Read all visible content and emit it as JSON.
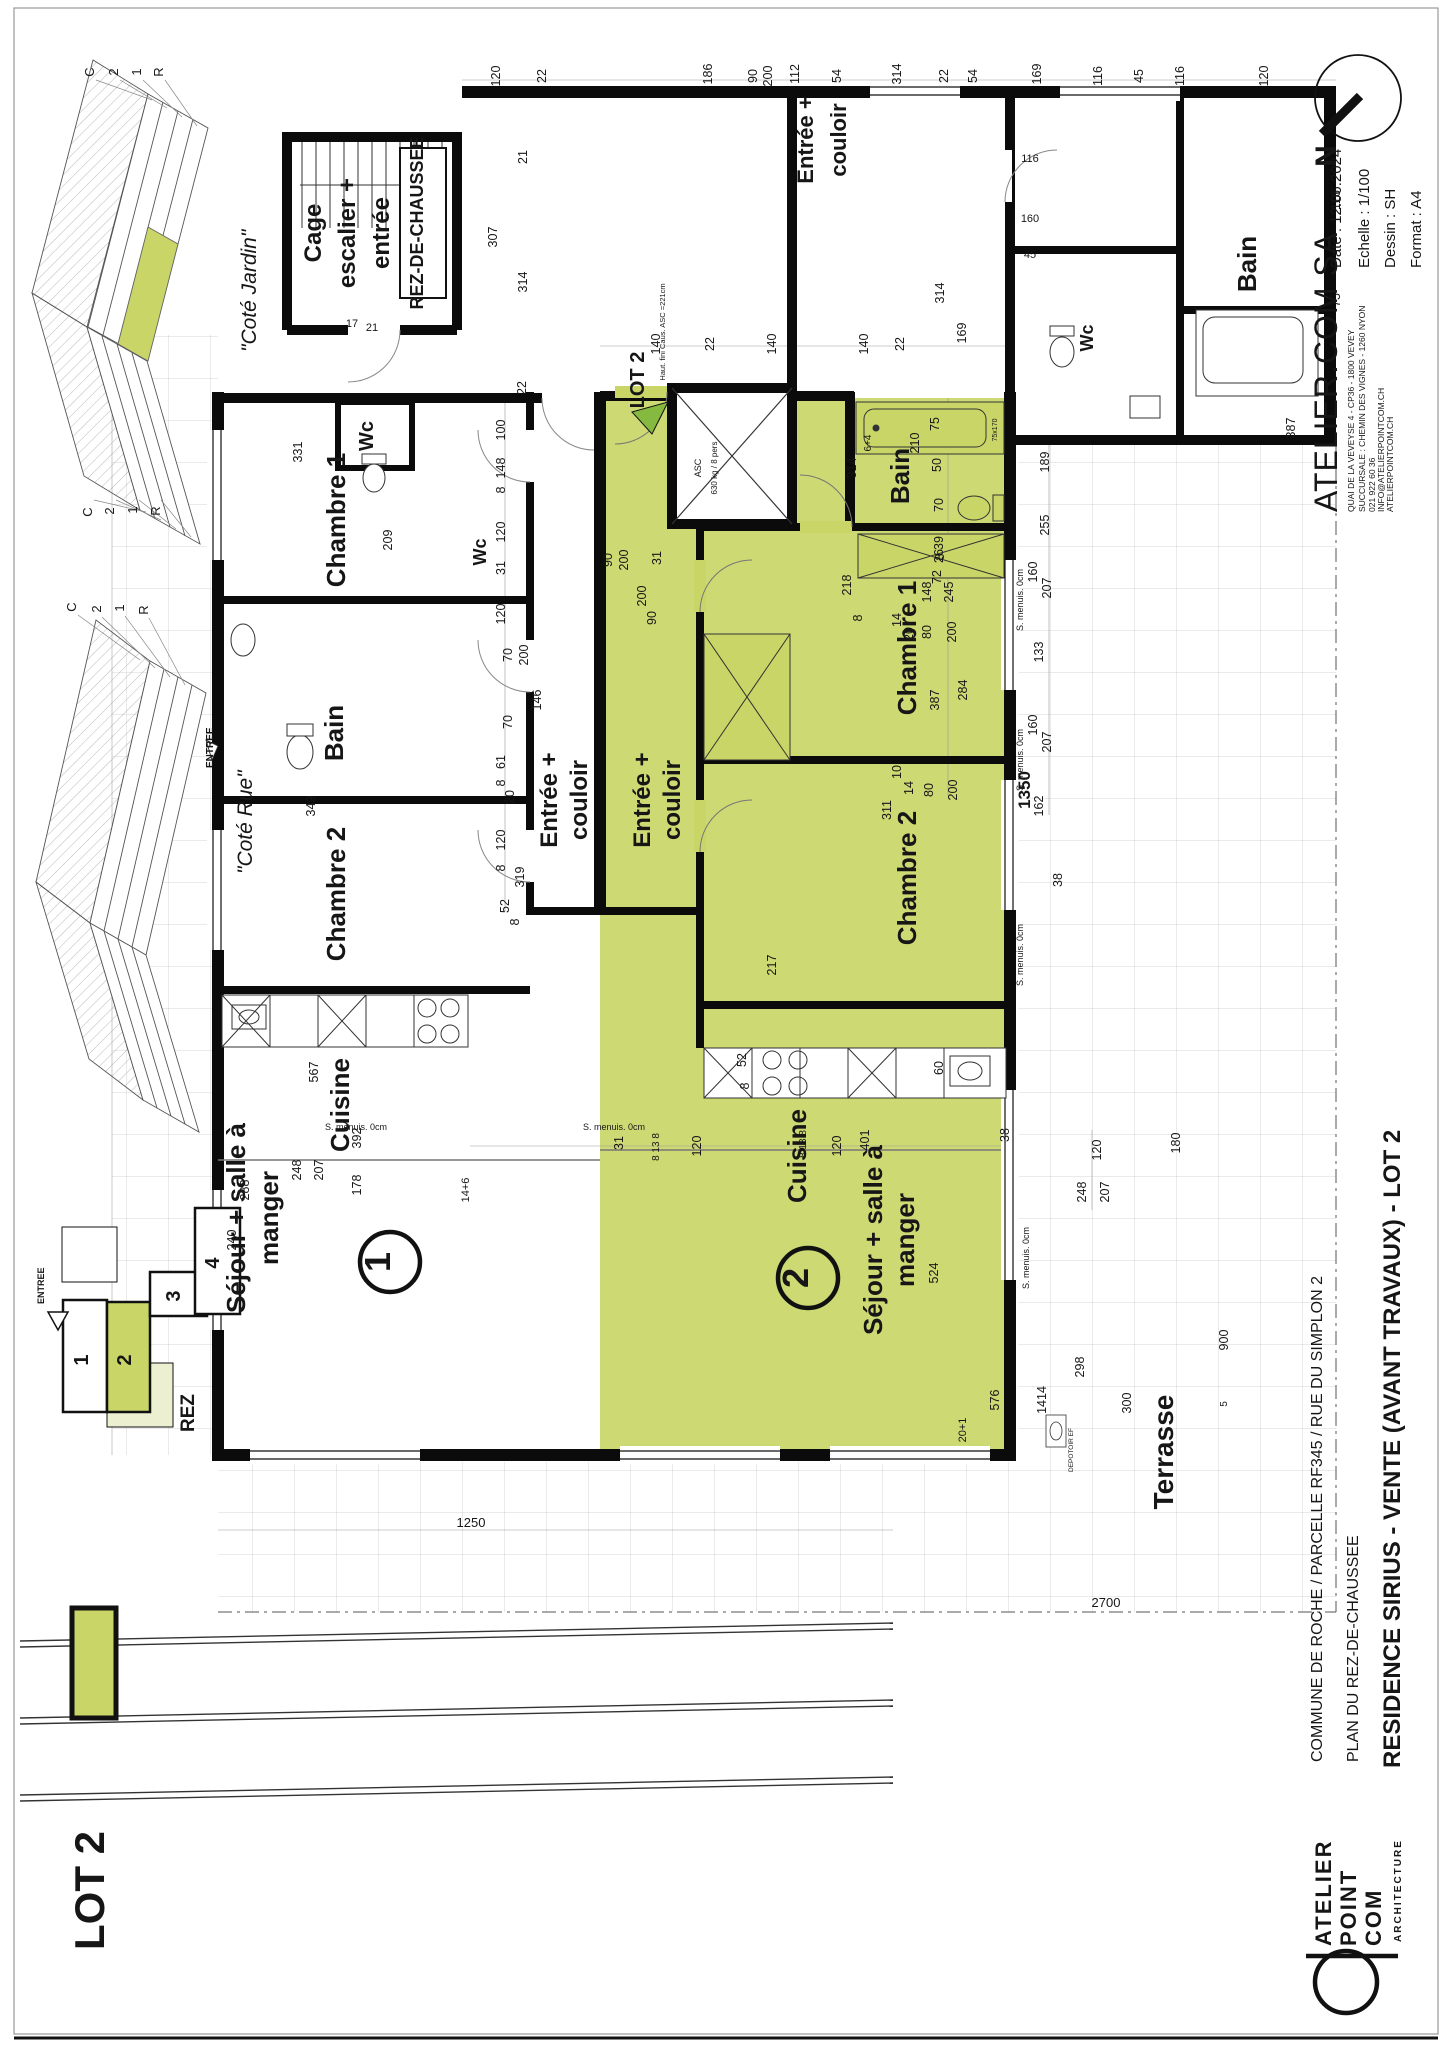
{
  "document": {
    "type": "architectural floor plan sheet",
    "sheet_format": "A4 landscape rotated 90deg CCW"
  },
  "colors": {
    "lot_green": "#c9d667",
    "terrace_light_green": "#edf0d0",
    "arrow_green": "#86b93f",
    "wall_black": "#0b0b0b",
    "grid_gray": "#c9c9c9"
  },
  "groups": {
    "title_block": [
      {
        "t": "Date : 12.06.2024",
        "x": 1341,
        "y": 268,
        "s": 15,
        "a": "start"
      },
      {
        "t": "Echelle : 1/100",
        "x": 1369,
        "y": 268,
        "s": 15,
        "a": "start"
      },
      {
        "t": "Dessin : SH",
        "x": 1395,
        "y": 268,
        "s": 15,
        "a": "start"
      },
      {
        "t": "Format : A4",
        "x": 1421,
        "y": 268,
        "s": 15,
        "a": "start"
      },
      {
        "t": "ATELIER.COM SA",
        "x": 1337,
        "y": 512,
        "s": 32,
        "a": "start",
        "ls": 1
      },
      {
        "t": "QUAI DE LA VEVEYSE 4 - CP36 - 1800 VEVEY",
        "x": 1354,
        "y": 512,
        "s": 8.5,
        "a": "start"
      },
      {
        "t": "SUCCURSALE : CHEMIN DES VIGNES - 1260 NYON",
        "x": 1365,
        "y": 512,
        "s": 8.5,
        "a": "start"
      },
      {
        "t": "021 922 60 36",
        "x": 1375,
        "y": 512,
        "s": 8.5,
        "a": "start"
      },
      {
        "t": "INFO@ATELIERPOINTCOM.CH",
        "x": 1384,
        "y": 512,
        "s": 8.5,
        "a": "start"
      },
      {
        "t": "ATELIERPOINTCOM.CH",
        "x": 1393,
        "y": 512,
        "s": 8.5,
        "a": "start"
      },
      {
        "t": "COMMUNE DE ROCHE / PARCELLE RF345 / RUE DU SIMPLON 2",
        "x": 1322,
        "y": 1762,
        "s": 16,
        "a": "start"
      },
      {
        "t": "PLAN DU REZ-DE-CHAUSSEE",
        "x": 1358,
        "y": 1762,
        "s": 16,
        "a": "start"
      },
      {
        "t": "RESIDENCE SIRIUS  -  VENTE (AVANT TRAVAUX)  -  LOT 2",
        "x": 1400,
        "y": 1768,
        "s": 24,
        "b": 1,
        "a": "start"
      },
      {
        "t": "N",
        "x": 1336,
        "y": 156,
        "s": 30,
        "b": 1
      }
    ],
    "logo": [
      {
        "t": "ATELIER",
        "x": 1331,
        "y": 1946,
        "s": 22,
        "b": 1,
        "a": "start",
        "ls": 2
      },
      {
        "t": "POINT",
        "x": 1356,
        "y": 1946,
        "s": 22,
        "b": 1,
        "a": "start",
        "ls": 2
      },
      {
        "t": "COM",
        "x": 1381,
        "y": 1946,
        "s": 22,
        "b": 1,
        "a": "start",
        "ls": 2
      },
      {
        "t": "ARCHITECTURE",
        "x": 1401,
        "y": 1942,
        "s": 10,
        "b": 1,
        "a": "start",
        "ls": 2
      }
    ],
    "legend": [
      {
        "t": "LOT 2",
        "x": 104,
        "y": 1950,
        "s": 42,
        "b": 1,
        "a": "start"
      }
    ],
    "keyplan": [
      {
        "t": "1",
        "x": 88,
        "y": 1360,
        "s": 20,
        "b": 1
      },
      {
        "t": "2",
        "x": 131,
        "y": 1360,
        "s": 20,
        "b": 1
      },
      {
        "t": "3",
        "x": 180,
        "y": 1296,
        "s": 20,
        "b": 1
      },
      {
        "t": "4",
        "x": 219,
        "y": 1263,
        "s": 20,
        "b": 1
      },
      {
        "t": "ENTREE",
        "x": 44,
        "y": 1304,
        "s": 9,
        "b": 1,
        "a": "start"
      },
      {
        "t": "REZ",
        "x": 194,
        "y": 1432,
        "s": 19,
        "b": 1,
        "a": "start"
      }
    ],
    "axo": [
      {
        "t": "\"Coté Jardin\"",
        "x": 256,
        "y": 352,
        "s": 21,
        "i": 1,
        "a": "start"
      },
      {
        "t": "\"Coté Rue\"",
        "x": 252,
        "y": 874,
        "s": 21,
        "i": 1,
        "a": "start"
      },
      {
        "t": "C",
        "x": 94,
        "y": 72,
        "s": 13
      },
      {
        "t": "2",
        "x": 118,
        "y": 72,
        "s": 13
      },
      {
        "t": "1",
        "x": 141,
        "y": 72,
        "s": 13
      },
      {
        "t": "R",
        "x": 163,
        "y": 72,
        "s": 13
      },
      {
        "t": "C",
        "x": 92,
        "y": 512,
        "s": 13
      },
      {
        "t": "2",
        "x": 114,
        "y": 511,
        "s": 13
      },
      {
        "t": "1",
        "x": 137,
        "y": 510,
        "s": 13
      },
      {
        "t": "R",
        "x": 160,
        "y": 511,
        "s": 13
      },
      {
        "t": "C",
        "x": 76,
        "y": 607,
        "s": 13
      },
      {
        "t": "2",
        "x": 101,
        "y": 609,
        "s": 13
      },
      {
        "t": "1",
        "x": 124,
        "y": 608,
        "s": 13
      },
      {
        "t": "R",
        "x": 148,
        "y": 610,
        "s": 13
      },
      {
        "t": "ENTREE",
        "x": 213,
        "y": 768,
        "s": 10,
        "b": 1,
        "a": "start"
      }
    ],
    "rooms": [
      {
        "t": "Cage",
        "x": 321,
        "y": 233,
        "s": 24,
        "b": 1
      },
      {
        "t": "escalier +",
        "x": 355,
        "y": 233,
        "s": 24,
        "b": 1
      },
      {
        "t": "entrée",
        "x": 389,
        "y": 233,
        "s": 24,
        "b": 1
      },
      {
        "t": "REZ-DE-CHAUSSEE",
        "x": 423,
        "y": 223,
        "s": 18,
        "b": 1
      },
      {
        "t": "Chambre 1",
        "x": 345,
        "y": 520,
        "s": 26,
        "b": 1
      },
      {
        "t": "Wc",
        "x": 373,
        "y": 436,
        "s": 20,
        "b": 1
      },
      {
        "t": "Bain",
        "x": 343,
        "y": 733,
        "s": 26,
        "b": 1
      },
      {
        "t": "Chambre 2",
        "x": 345,
        "y": 894,
        "s": 26,
        "b": 1
      },
      {
        "t": "Cuisine",
        "x": 349,
        "y": 1105,
        "s": 26,
        "b": 1
      },
      {
        "t": "Séjour + salle à",
        "x": 245,
        "y": 1218,
        "s": 26,
        "b": 1
      },
      {
        "t": "manger",
        "x": 278,
        "y": 1218,
        "s": 26,
        "b": 1
      },
      {
        "t": "Entrée +",
        "x": 557,
        "y": 800,
        "s": 24,
        "b": 1
      },
      {
        "t": "couloir",
        "x": 587,
        "y": 800,
        "s": 24,
        "b": 1
      },
      {
        "t": "Wc",
        "x": 486,
        "y": 552,
        "s": 18,
        "b": 1
      },
      {
        "t": "Entrée +",
        "x": 650,
        "y": 800,
        "s": 24,
        "b": 1
      },
      {
        "t": "couloir",
        "x": 680,
        "y": 800,
        "s": 24,
        "b": 1
      },
      {
        "t": "Bain",
        "x": 909,
        "y": 476,
        "s": 26,
        "b": 1
      },
      {
        "t": "Chambre 1",
        "x": 916,
        "y": 648,
        "s": 26,
        "b": 1
      },
      {
        "t": "Chambre 2",
        "x": 916,
        "y": 878,
        "s": 26,
        "b": 1
      },
      {
        "t": "Cuisine",
        "x": 806,
        "y": 1156,
        "s": 26,
        "b": 1
      },
      {
        "t": "Séjour + salle à",
        "x": 882,
        "y": 1240,
        "s": 26,
        "b": 1
      },
      {
        "t": "manger",
        "x": 914,
        "y": 1240,
        "s": 26,
        "b": 1
      },
      {
        "t": "Entrée +",
        "x": 813,
        "y": 140,
        "s": 22,
        "b": 1
      },
      {
        "t": "couloir",
        "x": 846,
        "y": 140,
        "s": 22,
        "b": 1
      },
      {
        "t": "Wc",
        "x": 1093,
        "y": 338,
        "s": 18,
        "b": 1
      },
      {
        "t": "Bain",
        "x": 1256,
        "y": 264,
        "s": 26,
        "b": 1
      },
      {
        "t": "Terrasse",
        "x": 1173,
        "y": 1452,
        "s": 28,
        "b": 1
      },
      {
        "t": "LOT 2",
        "x": 644,
        "y": 380,
        "s": 20,
        "b": 1
      },
      {
        "t": "1",
        "x": 390,
        "y": 1262,
        "s": 36,
        "b": 1
      },
      {
        "t": "2",
        "x": 808,
        "y": 1278,
        "s": 36,
        "b": 1
      }
    ],
    "notes": [
      {
        "t": "ASC",
        "x": 701,
        "y": 468,
        "s": 9
      },
      {
        "t": "630 kg / 8 pers",
        "x": 717,
        "y": 468,
        "s": 8
      },
      {
        "t": "Haut. fini Caus. ASC =221cm",
        "x": 665,
        "y": 332,
        "s": 7.5
      },
      {
        "t": "S. menuis. 0cm",
        "x": 1023,
        "y": 600,
        "s": 9
      },
      {
        "t": "S. menuis. 0cm",
        "x": 1023,
        "y": 760,
        "s": 9
      },
      {
        "t": "S. menuis. 0cm",
        "x": 1023,
        "y": 955,
        "s": 9
      },
      {
        "t": "S. menuis. 0cm",
        "x": 1029,
        "y": 1258,
        "s": 9
      },
      {
        "t": "S. menuis. 0cm",
        "x": 356,
        "y": 1130,
        "s": 9,
        "r": 0
      },
      {
        "t": "S. menuis. 0cm",
        "x": 614,
        "y": 1130,
        "s": 9,
        "r": 0
      },
      {
        "t": "DEPOTOIR EF",
        "x": 1073,
        "y": 1450,
        "s": 6.5
      },
      {
        "t": "75x170",
        "x": 997,
        "y": 430,
        "s": 7
      }
    ],
    "dims": [
      {
        "t": "120",
        "x": 500,
        "y": 76
      },
      {
        "t": "22",
        "x": 546,
        "y": 76
      },
      {
        "t": "186",
        "x": 712,
        "y": 74
      },
      {
        "t": "90",
        "x": 757,
        "y": 76
      },
      {
        "t": "200",
        "x": 772,
        "y": 76
      },
      {
        "t": "112",
        "x": 799,
        "y": 74
      },
      {
        "t": "54",
        "x": 841,
        "y": 76
      },
      {
        "t": "314",
        "x": 901,
        "y": 74
      },
      {
        "t": "22",
        "x": 948,
        "y": 76
      },
      {
        "t": "54",
        "x": 977,
        "y": 76
      },
      {
        "t": "169",
        "x": 1041,
        "y": 74
      },
      {
        "t": "116",
        "x": 1102,
        "y": 76
      },
      {
        "t": "45",
        "x": 1143,
        "y": 76
      },
      {
        "t": "116",
        "x": 1184,
        "y": 76
      },
      {
        "t": "120",
        "x": 1268,
        "y": 76
      },
      {
        "t": "140",
        "x": 660,
        "y": 344
      },
      {
        "t": "22",
        "x": 714,
        "y": 344
      },
      {
        "t": "140",
        "x": 776,
        "y": 344
      },
      {
        "t": "140",
        "x": 868,
        "y": 344
      },
      {
        "t": "22",
        "x": 904,
        "y": 344
      },
      {
        "t": "307",
        "x": 497,
        "y": 237
      },
      {
        "t": "314",
        "x": 527,
        "y": 282
      },
      {
        "t": "21",
        "x": 527,
        "y": 157
      },
      {
        "t": "22",
        "x": 526,
        "y": 388
      },
      {
        "t": "17",
        "x": 352,
        "y": 327,
        "r": 0,
        "s": 11
      },
      {
        "t": "21",
        "x": 372,
        "y": 331,
        "r": 0,
        "s": 11
      },
      {
        "t": "314",
        "x": 944,
        "y": 293
      },
      {
        "t": "169",
        "x": 966,
        "y": 333
      },
      {
        "t": "116",
        "x": 1030,
        "y": 162,
        "r": 0,
        "s": 11
      },
      {
        "t": "160",
        "x": 1030,
        "y": 222,
        "r": 0,
        "s": 11
      },
      {
        "t": "45",
        "x": 1030,
        "y": 258,
        "r": 0,
        "s": 11
      },
      {
        "t": "116",
        "x": 1340,
        "y": 200
      },
      {
        "t": "75",
        "x": 1340,
        "y": 300
      },
      {
        "t": "387",
        "x": 1295,
        "y": 428
      },
      {
        "t": "331",
        "x": 302,
        "y": 452
      },
      {
        "t": "209",
        "x": 392,
        "y": 540
      },
      {
        "t": "349",
        "x": 315,
        "y": 806
      },
      {
        "t": "392",
        "x": 361,
        "y": 1138
      },
      {
        "t": "567",
        "x": 318,
        "y": 1072
      },
      {
        "t": "100",
        "x": 505,
        "y": 430
      },
      {
        "t": "148",
        "x": 505,
        "y": 468
      },
      {
        "t": "8",
        "x": 505,
        "y": 490
      },
      {
        "t": "120",
        "x": 505,
        "y": 532
      },
      {
        "t": "31",
        "x": 505,
        "y": 568
      },
      {
        "t": "120",
        "x": 505,
        "y": 614
      },
      {
        "t": "90",
        "x": 612,
        "y": 560
      },
      {
        "t": "200",
        "x": 628,
        "y": 560
      },
      {
        "t": "70",
        "x": 512,
        "y": 655
      },
      {
        "t": "200",
        "x": 528,
        "y": 655
      },
      {
        "t": "146",
        "x": 541,
        "y": 700
      },
      {
        "t": "70",
        "x": 512,
        "y": 722
      },
      {
        "t": "61",
        "x": 505,
        "y": 762
      },
      {
        "t": "8",
        "x": 505,
        "y": 783
      },
      {
        "t": "20",
        "x": 514,
        "y": 797
      },
      {
        "t": "120",
        "x": 505,
        "y": 840
      },
      {
        "t": "8",
        "x": 505,
        "y": 868
      },
      {
        "t": "319",
        "x": 524,
        "y": 877
      },
      {
        "t": "52",
        "x": 509,
        "y": 906
      },
      {
        "t": "8",
        "x": 519,
        "y": 922
      },
      {
        "t": "31",
        "x": 661,
        "y": 558
      },
      {
        "t": "200",
        "x": 646,
        "y": 596
      },
      {
        "t": "90",
        "x": 656,
        "y": 618
      },
      {
        "t": "218",
        "x": 851,
        "y": 585
      },
      {
        "t": "8",
        "x": 862,
        "y": 618
      },
      {
        "t": "148",
        "x": 931,
        "y": 592
      },
      {
        "t": "14",
        "x": 901,
        "y": 620
      },
      {
        "t": "20",
        "x": 913,
        "y": 634
      },
      {
        "t": "26",
        "x": 943,
        "y": 556
      },
      {
        "t": "80",
        "x": 931,
        "y": 632
      },
      {
        "t": "200",
        "x": 956,
        "y": 632
      },
      {
        "t": "10",
        "x": 901,
        "y": 772
      },
      {
        "t": "14",
        "x": 913,
        "y": 788
      },
      {
        "t": "80",
        "x": 933,
        "y": 790
      },
      {
        "t": "200",
        "x": 957,
        "y": 790
      },
      {
        "t": "387",
        "x": 939,
        "y": 700
      },
      {
        "t": "284",
        "x": 967,
        "y": 690
      },
      {
        "t": "311",
        "x": 891,
        "y": 810
      },
      {
        "t": "217",
        "x": 776,
        "y": 965
      },
      {
        "t": "52",
        "x": 746,
        "y": 1060
      },
      {
        "t": "8",
        "x": 749,
        "y": 1086
      },
      {
        "t": "60",
        "x": 943,
        "y": 1068
      },
      {
        "t": "401",
        "x": 869,
        "y": 1140
      },
      {
        "t": "8 13 8",
        "x": 806,
        "y": 1144,
        "s": 10
      },
      {
        "t": "120",
        "x": 841,
        "y": 1146
      },
      {
        "t": "31",
        "x": 623,
        "y": 1143
      },
      {
        "t": "8 13 8",
        "x": 659,
        "y": 1147,
        "s": 10
      },
      {
        "t": "120",
        "x": 701,
        "y": 1146
      },
      {
        "t": "524",
        "x": 938,
        "y": 1273
      },
      {
        "t": "576",
        "x": 999,
        "y": 1400
      },
      {
        "t": "14+6",
        "x": 469,
        "y": 1190,
        "s": 11
      },
      {
        "t": "20+1",
        "x": 966,
        "y": 1430,
        "s": 11
      },
      {
        "t": "314",
        "x": 856,
        "y": 468
      },
      {
        "t": "210",
        "x": 919,
        "y": 443
      },
      {
        "t": "75",
        "x": 939,
        "y": 424
      },
      {
        "t": "50",
        "x": 941,
        "y": 465
      },
      {
        "t": "70",
        "x": 943,
        "y": 505
      },
      {
        "t": "39",
        "x": 943,
        "y": 543
      },
      {
        "t": "8",
        "x": 944,
        "y": 557
      },
      {
        "t": "72",
        "x": 941,
        "y": 577
      },
      {
        "t": "245",
        "x": 953,
        "y": 592
      },
      {
        "t": "6+4",
        "x": 871,
        "y": 443,
        "s": 10
      },
      {
        "t": "189",
        "x": 1049,
        "y": 462
      },
      {
        "t": "255",
        "x": 1049,
        "y": 525
      },
      {
        "t": "160",
        "x": 1037,
        "y": 572
      },
      {
        "t": "207",
        "x": 1051,
        "y": 588
      },
      {
        "t": "133",
        "x": 1043,
        "y": 652
      },
      {
        "t": "160",
        "x": 1037,
        "y": 725
      },
      {
        "t": "207",
        "x": 1051,
        "y": 742
      },
      {
        "t": "162",
        "x": 1043,
        "y": 806
      },
      {
        "t": "1350",
        "x": 1030,
        "y": 790,
        "s": 17,
        "b": 1
      },
      {
        "t": "38",
        "x": 1062,
        "y": 880
      },
      {
        "t": "38",
        "x": 1009,
        "y": 1135
      },
      {
        "t": "120",
        "x": 1101,
        "y": 1150
      },
      {
        "t": "248",
        "x": 1086,
        "y": 1192
      },
      {
        "t": "207",
        "x": 1109,
        "y": 1192
      },
      {
        "t": "180",
        "x": 1180,
        "y": 1143
      },
      {
        "t": "298",
        "x": 1084,
        "y": 1367
      },
      {
        "t": "900",
        "x": 1228,
        "y": 1340
      },
      {
        "t": "1414",
        "x": 1046,
        "y": 1400
      },
      {
        "t": "300",
        "x": 1131,
        "y": 1403
      },
      {
        "t": "5",
        "x": 1227,
        "y": 1404,
        "s": 10
      },
      {
        "t": "288",
        "x": 249,
        "y": 1190
      },
      {
        "t": "248",
        "x": 301,
        "y": 1170
      },
      {
        "t": "207",
        "x": 323,
        "y": 1170
      },
      {
        "t": "178",
        "x": 361,
        "y": 1185
      },
      {
        "t": "240",
        "x": 236,
        "y": 1240
      },
      {
        "t": "1250",
        "x": 471,
        "y": 1527,
        "r": 0,
        "s": 13
      },
      {
        "t": "2700",
        "x": 1106,
        "y": 1607,
        "r": 0,
        "s": 13
      }
    ]
  }
}
